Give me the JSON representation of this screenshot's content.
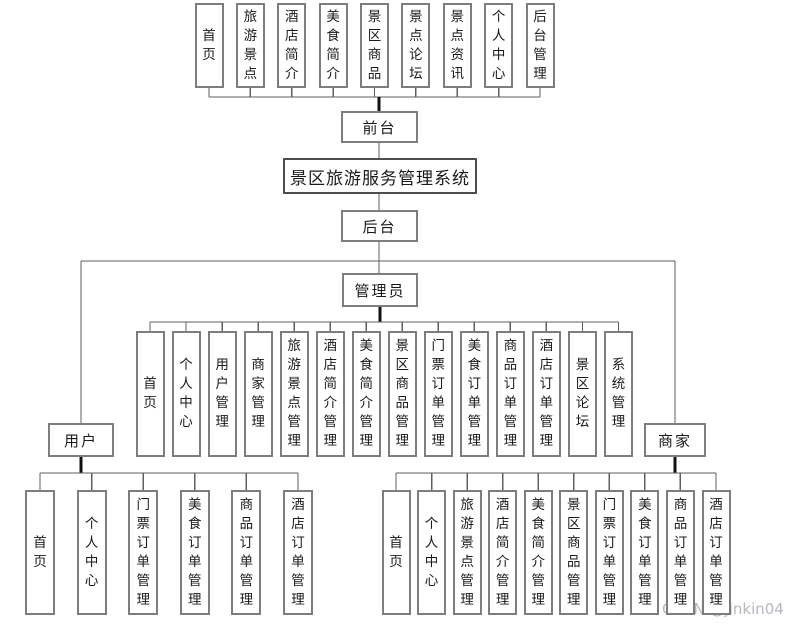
{
  "title": "景区旅游服务管理系统",
  "front": {
    "label": "前台",
    "children": [
      "首页",
      "旅游景点",
      "酒店简介",
      "美食简介",
      "景区商品",
      "景点论坛",
      "景点资讯",
      "个人中心",
      "后台管理"
    ]
  },
  "back": {
    "label": "后台",
    "admin": {
      "label": "管理员",
      "children": [
        "首页",
        "个人中心",
        "用户管理",
        "商家管理",
        "旅游景点管理",
        "酒店简介管理",
        "美食简介管理",
        "景区商品管理",
        "门票订单管理",
        "美食订单管理",
        "商品订单管理",
        "酒店订单管理",
        "景区论坛",
        "系统管理"
      ]
    },
    "user": {
      "label": "用户",
      "children": [
        "首页",
        "个人中心",
        "门票订单管理",
        "美食订单管理",
        "商品订单管理",
        "酒店订单管理"
      ]
    },
    "merchant": {
      "label": "商家",
      "children": [
        "首页",
        "个人中心",
        "旅游景点管理",
        "酒店简介管理",
        "美食简介管理",
        "景区商品管理",
        "门票订单管理",
        "美食订单管理",
        "商品订单管理",
        "酒店订单管理"
      ]
    }
  },
  "watermark": "CSDN @jinkin04",
  "colors": {
    "background": "#ffffff",
    "box_border": "#7d7d7d",
    "title_border": "#4d4d4d",
    "line": "#5f5f5f",
    "line_thick": "#111111",
    "text": "#1a1a1a",
    "watermark": "#b7b7c0"
  }
}
